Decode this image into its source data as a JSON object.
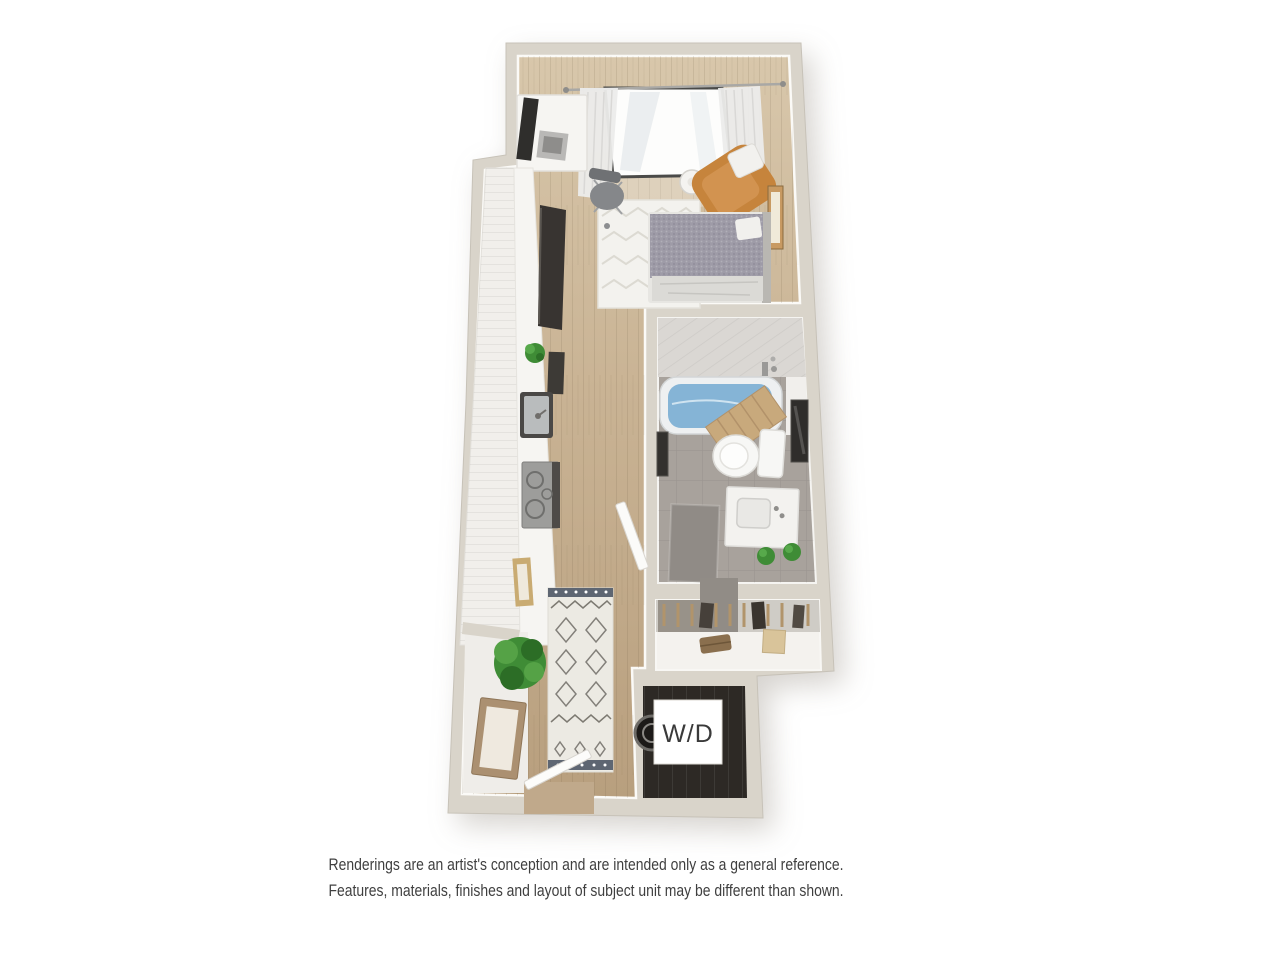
{
  "floor_plan": {
    "kind": "studio-apartment-3d-floor-plan",
    "wd_label": "W/D",
    "colors": {
      "exterior_wall": "#d9d4ca",
      "bathroom_tile": "#a8a29c",
      "shower_band": "#dad7d3",
      "tub_water": "#85b4d6",
      "accent_chair": "#c6843c",
      "bed_duvet": "#9e9ba7",
      "bed_sheet": "#dbdad6",
      "rug_white": "#f3f2ee",
      "hall_rug": "#eceae3",
      "counter_white": "#f6f5f2",
      "appliance_dark": "#383431",
      "plant_green": "#3f8c36",
      "ladder_wood": "#c8a97c",
      "closet_shelf": "#f4f2ee",
      "wd_floor": "#2d2925",
      "wd_label_bg": "#ffffff",
      "wd_label_text": "#3a3a3a",
      "bath_mat": "#908b86"
    }
  },
  "disclaimer": {
    "line1": "Renderings are an artist's conception and are intended only as a general reference.",
    "line2": "Features, materials, finishes and layout of subject unit may be different than shown."
  }
}
